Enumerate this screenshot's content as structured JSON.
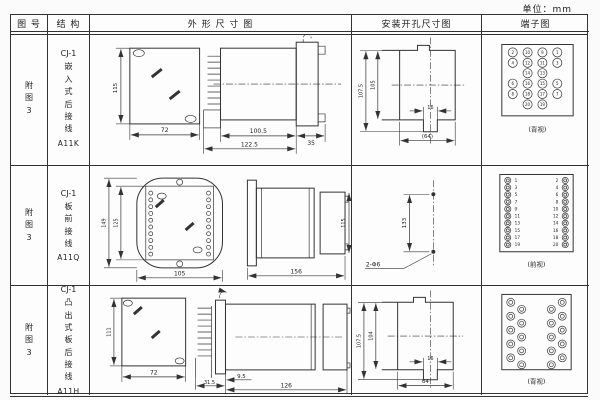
{
  "unit_label": "单位：mm",
  "table": {
    "headers": [
      "图 号",
      "结 构",
      "外 形 尺 寸 图",
      "安装开孔尺寸图",
      "端子图"
    ]
  },
  "rows": [
    {
      "fig_no": "附图3",
      "structure": {
        "series": "CJ-1",
        "type": "嵌入式后接线",
        "model": "A11K"
      },
      "outline": {
        "h": "115",
        "w": "72",
        "l1": "100.5",
        "l2": "122.5",
        "l3": "35"
      },
      "install": {
        "oh": "107.5",
        "ih": "105",
        "nw": "16",
        "cw": "(64)"
      },
      "terminal": {
        "view": "(背视)",
        "grid": [
          [
            "2",
            "10",
            "9",
            "1"
          ],
          [
            "4",
            "12",
            "11",
            "3"
          ],
          [
            null,
            "14",
            "13",
            null
          ],
          [
            "6",
            "16",
            "15",
            "5"
          ],
          [
            "8",
            "18",
            "17",
            "7"
          ],
          [
            null,
            "20",
            "19",
            null
          ]
        ]
      }
    },
    {
      "fig_no": "附图3",
      "structure": {
        "series": "CJ-1",
        "type": "板前接线",
        "model": "A11Q"
      },
      "outline": {
        "oh": "149",
        "ih": "125",
        "w": "105",
        "len": "156",
        "bh": "115"
      },
      "install": {
        "sp": "133",
        "hole": "2-Φ6"
      },
      "terminal": {
        "view": "(前视)",
        "left": [
          "1",
          "3",
          "5",
          "7",
          "9",
          "11",
          "13",
          "15",
          "17",
          "19"
        ],
        "right": [
          "2",
          "4",
          "6",
          "8",
          "10",
          "12",
          "14",
          "16",
          "18",
          "20"
        ]
      }
    },
    {
      "fig_no": "附图3",
      "structure": {
        "series": "CJ-1",
        "type": "凸出式板后接线",
        "model": "A11H"
      },
      "outline": {
        "h": "111",
        "w": "72",
        "p": "31.5",
        "off": "9.5",
        "len": "126"
      },
      "install": {
        "oh": "107.5",
        "ih": "104",
        "nw": "16",
        "cw": "64"
      },
      "terminal": {
        "view": "(背视)"
      }
    }
  ]
}
